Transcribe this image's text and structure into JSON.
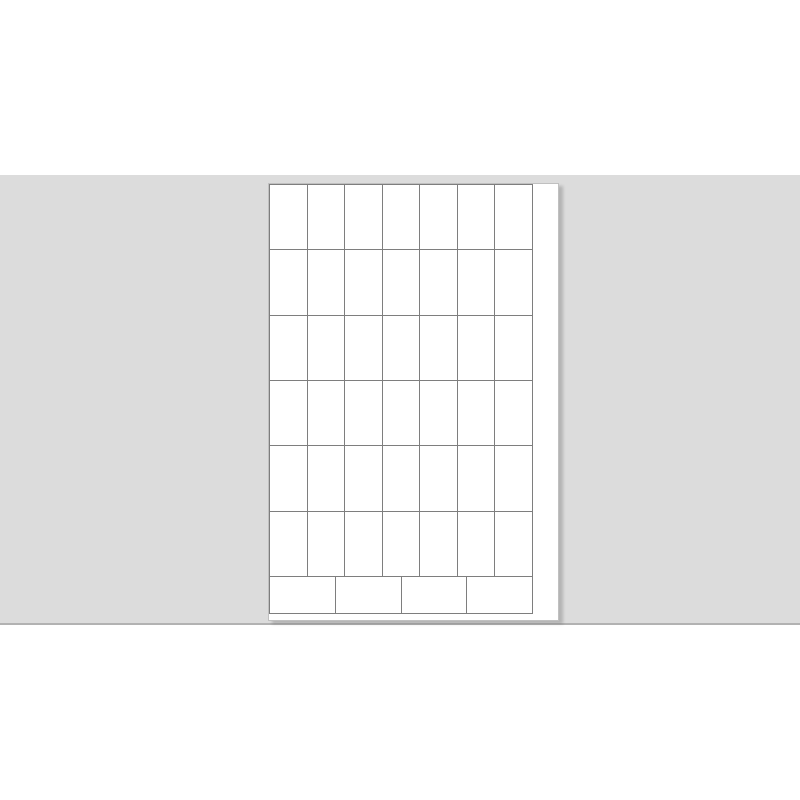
{
  "colors": {
    "app_bg": "#ffffff",
    "desk_bg": "#dcdcdc",
    "desk_border": "#b2b2b2",
    "sheet_bg": "#ffffff",
    "sheet_edge": "#c0c0c0",
    "grid_line": "#7e7e7e",
    "shadow": "rgba(0,0,0,0.18)"
  },
  "sheet": {
    "description_of_content": "blank label sheet template, no printed text",
    "portrait_labels": {
      "rows": 6,
      "columns": 7,
      "count": 42
    },
    "landscape_labels": {
      "rows": 1,
      "columns": 4,
      "count": 4
    },
    "total_labels": 46
  }
}
